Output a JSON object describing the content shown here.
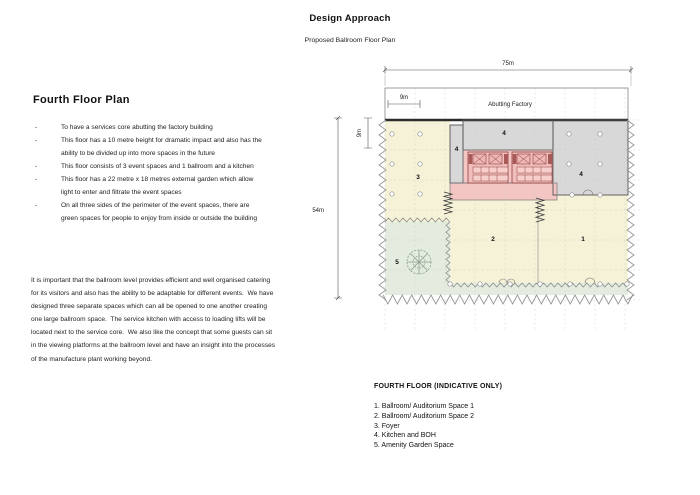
{
  "page": {
    "title": "Design Approach",
    "subtitle": "Proposed Ballroom Floor Plan"
  },
  "left": {
    "heading": "Fourth Floor Plan",
    "bullets": [
      "To have a services core abutting the factory building",
      "This floor has a 10 metre height for dramatic impact and also has the ability to be divided up into more spaces in the future",
      "This floor consists of 3 event spaces and 1 ballroom and a kitchen",
      "This floor has a 22 metre x 18 metres external garden which allow light to enter and filtrate the event spaces",
      "On all three sides of the perimeter of the event spaces, there are green spaces for people to enjoy from inside or outside the building"
    ],
    "paragraph": "It is important that the ballroom level provides efficient and well organised catering for its visitors and also has the ability to be adaptable for different events.  We have designed three separate spaces which can all be opened to one another creating one large ballroom space.  The service kitchen with access to loading lifts will be located next to the service core.  We also like the concept that some guests can sit in the viewing platforms at the ballroom level and have an insight into the processes of the manufacture plant working beyond."
  },
  "plan": {
    "abutting_label": "Abutting Factory",
    "dims": {
      "overall_width": "75m",
      "overall_depth": "54m",
      "bay_width": "9m",
      "bay_depth": "9m"
    },
    "spaces": {
      "space1": "1",
      "space2": "2",
      "foyer": "3",
      "kitchen_top": "4",
      "kitchen_strip": "4",
      "kitchen_right": "4",
      "garden": "5"
    },
    "colors": {
      "event_space": "#f5f2d7",
      "kitchen": "#d8d8d8",
      "core": "#f3c6c4",
      "core_dark": "#a85a58",
      "garden": "#e3ecdf",
      "factory_strip": "#ffffff"
    }
  },
  "legend": {
    "title": "FOURTH FLOOR (INDICATIVE ONLY)",
    "items": [
      "1. Ballroom/ Auditorium Space 1",
      "2. Ballroom/ Auditorium Space 2",
      "3. Foyer",
      "4. Kitchen and BOH",
      "5. Amenity Garden Space"
    ]
  }
}
